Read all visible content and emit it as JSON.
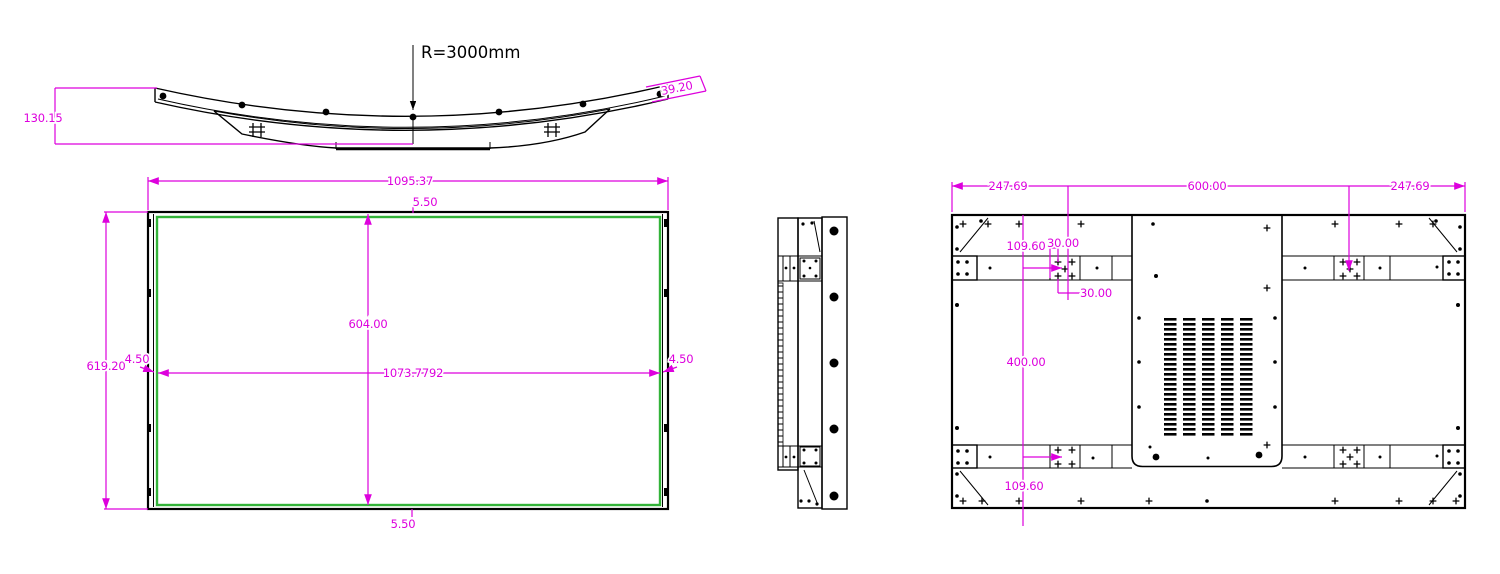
{
  "drawing": {
    "top_view": {
      "radius_label": "R=3000mm",
      "overall_depth": "130.15",
      "end_thickness": "39.20"
    },
    "front_view": {
      "overall_width": "1095.37",
      "overall_height": "619.20",
      "top_bezel": "5.50",
      "bottom_bezel": "5.50",
      "left_bezel": "4.50",
      "right_bezel": "4.50",
      "active_width": "1073.7792",
      "active_height": "604.00"
    },
    "rear_view": {
      "left_mount_span": "247.69",
      "center_mount_span": "600.00",
      "right_mount_span": "247.69",
      "top_mount_offset": "109.60",
      "vertical_mount_span": "400.00",
      "bottom_mount_offset": "109.60",
      "hole_pitch_horizontal": "30.00",
      "hole_pitch_vertical": "30.00"
    }
  },
  "colors": {
    "dimension": "#dd00dd",
    "active_area": "#33b339",
    "line": "#000000",
    "background": "#ffffff"
  }
}
